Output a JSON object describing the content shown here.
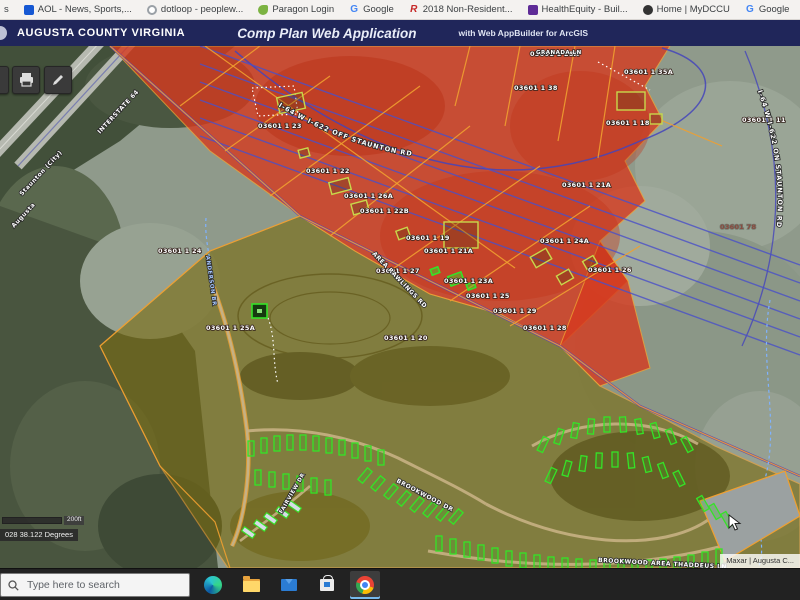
{
  "bookmarks_bar": {
    "items": [
      {
        "label": "s",
        "icon": "partial"
      },
      {
        "label": "AOL - News, Sports,...",
        "icon": "aol"
      },
      {
        "label": "dotloop - peoplew...",
        "icon": "dotloop"
      },
      {
        "label": "Paragon Login",
        "icon": "paragon",
        "icon_text": ""
      },
      {
        "label": "Google",
        "icon": "google",
        "icon_text": "G"
      },
      {
        "label": "2018 Non-Resident...",
        "icon": "doc2018",
        "icon_text": "R"
      },
      {
        "label": "HealthEquity - Buil...",
        "icon": "healthequity"
      },
      {
        "label": "Home | MyDCCU",
        "icon": "dccu"
      },
      {
        "label": "Google",
        "icon": "google",
        "icon_text": "G"
      },
      {
        "label": "Infinite Campus / St...",
        "icon": "blackboard",
        "icon_text": "Bb"
      }
    ]
  },
  "header": {
    "brand": "AUGUSTA COUNTY VIRGINIA",
    "title": "Comp Plan Web Application",
    "subtitle": "with Web AppBuilder for ArcGIS"
  },
  "map": {
    "attribution": "Maxar | Augusta C...",
    "coordinates": "028 38.122 Degrees",
    "scale_label": "200ft",
    "colors": {
      "zone_red": "#d63a1f",
      "zone_olive": "#7a6c12",
      "parcel_line": "#f0a030",
      "pipeline_blue": "#4a50c8",
      "corridor_purple": "#5a3fb5",
      "highlight_green": "#35e327",
      "building_outline": "#c8d84b",
      "stream_blue": "#7fb2ff"
    },
    "curved_labels": [
      {
        "text": "I-64 W I-622 OFF STAUNTON RD"
      },
      {
        "text": "I-64 W I-622 ON STAUNTON RD"
      }
    ],
    "road_labels": [
      {
        "text": "INTERSTATE 64",
        "x": 100,
        "y": 88,
        "rot": -47,
        "size": 6
      },
      {
        "text": "Staunton (City)",
        "x": 22,
        "y": 150,
        "rot": -47,
        "size": 6
      },
      {
        "text": "Augusta",
        "x": 14,
        "y": 182,
        "rot": -47,
        "size": 6
      },
      {
        "text": "GRANADA LN",
        "x": 536,
        "y": 8,
        "rot": 0,
        "size": 5.5
      },
      {
        "text": "AREA RAWLINGS RD",
        "x": 372,
        "y": 208,
        "rot": 46,
        "size": 6
      },
      {
        "text": "ANDERSON BR",
        "x": 206,
        "y": 210,
        "rot": 82,
        "size": 5.5,
        "color": "#a8c8ff"
      },
      {
        "text": "BROOKWOOD DR",
        "x": 396,
        "y": 436,
        "rot": 28,
        "size": 6
      },
      {
        "text": "FAIRVIEW DR",
        "x": 282,
        "y": 468,
        "rot": -60,
        "size": 5.5
      },
      {
        "text": "BROOKWOOD AREA THADDEUS LN",
        "x": 598,
        "y": 516,
        "rot": 3,
        "size": 6
      }
    ],
    "parcel_labels": [
      {
        "text": "03601 1   23",
        "x": 258,
        "y": 82
      },
      {
        "text": "03601 1   22",
        "x": 306,
        "y": 127
      },
      {
        "text": "03601 1   26A",
        "x": 344,
        "y": 152
      },
      {
        "text": "03601 1   22B",
        "x": 360,
        "y": 167
      },
      {
        "text": "03601 1   19",
        "x": 406,
        "y": 194
      },
      {
        "text": "03601 1   28A",
        "x": 530,
        "y": 10
      },
      {
        "text": "03601 1   35A",
        "x": 624,
        "y": 28
      },
      {
        "text": "03601 1   38",
        "x": 514,
        "y": 44
      },
      {
        "text": "03601 1   18",
        "x": 606,
        "y": 79
      },
      {
        "text": "03601 1   11",
        "x": 742,
        "y": 76
      },
      {
        "text": "03601 1   21A",
        "x": 562,
        "y": 141
      },
      {
        "text": "03601 1   24A",
        "x": 540,
        "y": 197
      },
      {
        "text": "03601 1   26",
        "x": 588,
        "y": 226
      },
      {
        "text": "03601 1   21A",
        "x": 424,
        "y": 207
      },
      {
        "text": "03601 1   27",
        "x": 376,
        "y": 227
      },
      {
        "text": "03601 1   23A",
        "x": 444,
        "y": 237
      },
      {
        "text": "03601 1   25",
        "x": 466,
        "y": 252
      },
      {
        "text": "03601 1   29",
        "x": 493,
        "y": 267
      },
      {
        "text": "03601 1   28",
        "x": 523,
        "y": 284
      },
      {
        "text": "03601 1   24",
        "x": 158,
        "y": 207
      },
      {
        "text": "03601 1   25A",
        "x": 206,
        "y": 284
      },
      {
        "text": "03601 1   20",
        "x": 384,
        "y": 294
      },
      {
        "text": "03601   78",
        "x": 720,
        "y": 183,
        "color": "#8a4a3e"
      }
    ],
    "pipeline_lines": [
      [
        200,
        0,
        800,
        219
      ],
      [
        200,
        18,
        800,
        237
      ],
      [
        200,
        36,
        800,
        255
      ],
      [
        200,
        54,
        800,
        273
      ],
      [
        200,
        72,
        800,
        291
      ],
      [
        200,
        90,
        800,
        309
      ]
    ],
    "orange_segments": [
      [
        [
          110,
          0
        ],
        [
          300,
          170
        ],
        [
          560,
          300
        ],
        [
          640,
          360
        ],
        [
          800,
          430
        ]
      ],
      [
        [
          100,
          300
        ],
        [
          210,
          205
        ],
        [
          300,
          170
        ]
      ],
      [
        [
          100,
          300
        ],
        [
          160,
          420
        ],
        [
          215,
          476
        ],
        [
          230,
          522
        ]
      ],
      [
        [
          180,
          60
        ],
        [
          260,
          0
        ]
      ],
      [
        [
          225,
          105
        ],
        [
          330,
          30
        ]
      ],
      [
        [
          270,
          150
        ],
        [
          420,
          40
        ]
      ],
      [
        [
          330,
          190
        ],
        [
          470,
          80
        ]
      ],
      [
        [
          390,
          225
        ],
        [
          540,
          120
        ]
      ],
      [
        [
          450,
          255
        ],
        [
          590,
          160
        ]
      ],
      [
        [
          510,
          280
        ],
        [
          640,
          200
        ]
      ],
      [
        [
          205,
          0
        ],
        [
          515,
          222
        ]
      ],
      [
        [
          470,
          0
        ],
        [
          455,
          60
        ]
      ],
      [
        [
          520,
          0
        ],
        [
          505,
          80
        ]
      ],
      [
        [
          575,
          0
        ],
        [
          558,
          95
        ]
      ],
      [
        [
          615,
          0
        ],
        [
          598,
          112
        ]
      ],
      [
        [
          663,
          75
        ],
        [
          722,
          100
        ]
      ]
    ],
    "olive_buildings": [
      [
        278,
        49,
        26,
        16,
        -12
      ],
      [
        330,
        134,
        20,
        12,
        -15
      ],
      [
        352,
        156,
        16,
        11,
        -15
      ],
      [
        299,
        103,
        10,
        8,
        -15
      ],
      [
        444,
        176,
        34,
        26,
        0
      ],
      [
        617,
        46,
        28,
        18,
        0
      ],
      [
        650,
        68,
        12,
        10,
        0
      ],
      [
        532,
        206,
        18,
        12,
        -30
      ],
      [
        558,
        226,
        14,
        10,
        -30
      ],
      [
        584,
        212,
        12,
        9,
        -30
      ],
      [
        397,
        183,
        12,
        9,
        -20
      ]
    ],
    "green_buildings": [
      [
        449,
        228,
        14,
        10,
        -20
      ],
      [
        431,
        222,
        8,
        6,
        -20
      ],
      [
        467,
        237,
        8,
        6,
        -20
      ]
    ],
    "park_homes": [
      [
        248,
        395,
        0
      ],
      [
        261,
        392,
        0
      ],
      [
        274,
        390,
        0
      ],
      [
        287,
        389,
        0
      ],
      [
        300,
        389,
        0
      ],
      [
        313,
        390,
        0
      ],
      [
        326,
        392,
        0
      ],
      [
        339,
        394,
        0
      ],
      [
        352,
        397,
        0
      ],
      [
        365,
        400,
        0
      ],
      [
        378,
        404,
        0
      ],
      [
        255,
        424,
        0
      ],
      [
        269,
        426,
        0
      ],
      [
        283,
        428,
        0
      ],
      [
        297,
        430,
        0
      ],
      [
        311,
        432,
        0
      ],
      [
        325,
        434,
        0
      ],
      [
        362,
        422,
        40
      ],
      [
        375,
        430,
        40
      ],
      [
        388,
        438,
        40
      ],
      [
        401,
        445,
        40
      ],
      [
        414,
        451,
        40
      ],
      [
        427,
        456,
        40
      ],
      [
        440,
        460,
        40
      ],
      [
        453,
        463,
        40
      ],
      [
        540,
        391,
        25
      ],
      [
        556,
        383,
        18
      ],
      [
        572,
        377,
        10
      ],
      [
        588,
        373,
        4
      ],
      [
        604,
        371,
        0
      ],
      [
        620,
        371,
        -4
      ],
      [
        636,
        373,
        -10
      ],
      [
        652,
        377,
        -16
      ],
      [
        668,
        383,
        -22
      ],
      [
        684,
        391,
        -28
      ],
      [
        548,
        422,
        25
      ],
      [
        564,
        415,
        16
      ],
      [
        580,
        410,
        8
      ],
      [
        596,
        407,
        2
      ],
      [
        612,
        406,
        0
      ],
      [
        628,
        407,
        -6
      ],
      [
        644,
        411,
        -14
      ],
      [
        660,
        417,
        -20
      ],
      [
        676,
        425,
        -26
      ],
      [
        436,
        490,
        0
      ],
      [
        450,
        493,
        0
      ],
      [
        464,
        496,
        0
      ],
      [
        478,
        499,
        0
      ],
      [
        492,
        502,
        0
      ],
      [
        506,
        505,
        0
      ],
      [
        520,
        507,
        0
      ],
      [
        534,
        509,
        0
      ],
      [
        548,
        511,
        0
      ],
      [
        562,
        512,
        0
      ],
      [
        576,
        513,
        0
      ],
      [
        590,
        514,
        0
      ],
      [
        604,
        515,
        0
      ],
      [
        618,
        515,
        0
      ],
      [
        632,
        515,
        0
      ],
      [
        646,
        514,
        0
      ],
      [
        660,
        513,
        0
      ],
      [
        674,
        511,
        0
      ],
      [
        688,
        509,
        0
      ],
      [
        702,
        506,
        0
      ],
      [
        716,
        503,
        0
      ],
      [
        700,
        450,
        -30
      ],
      [
        712,
        458,
        -30
      ],
      [
        724,
        466,
        -30
      ]
    ],
    "white_homes": [
      [
        268,
        466,
        -55
      ],
      [
        280,
        460,
        -55
      ],
      [
        292,
        454,
        -55
      ],
      [
        258,
        473,
        -55
      ],
      [
        246,
        480,
        -55
      ]
    ]
  },
  "taskbar": {
    "search_placeholder": "Type here to search",
    "icons": [
      "edge",
      "file-explorer",
      "mail",
      "store",
      "chrome"
    ]
  }
}
